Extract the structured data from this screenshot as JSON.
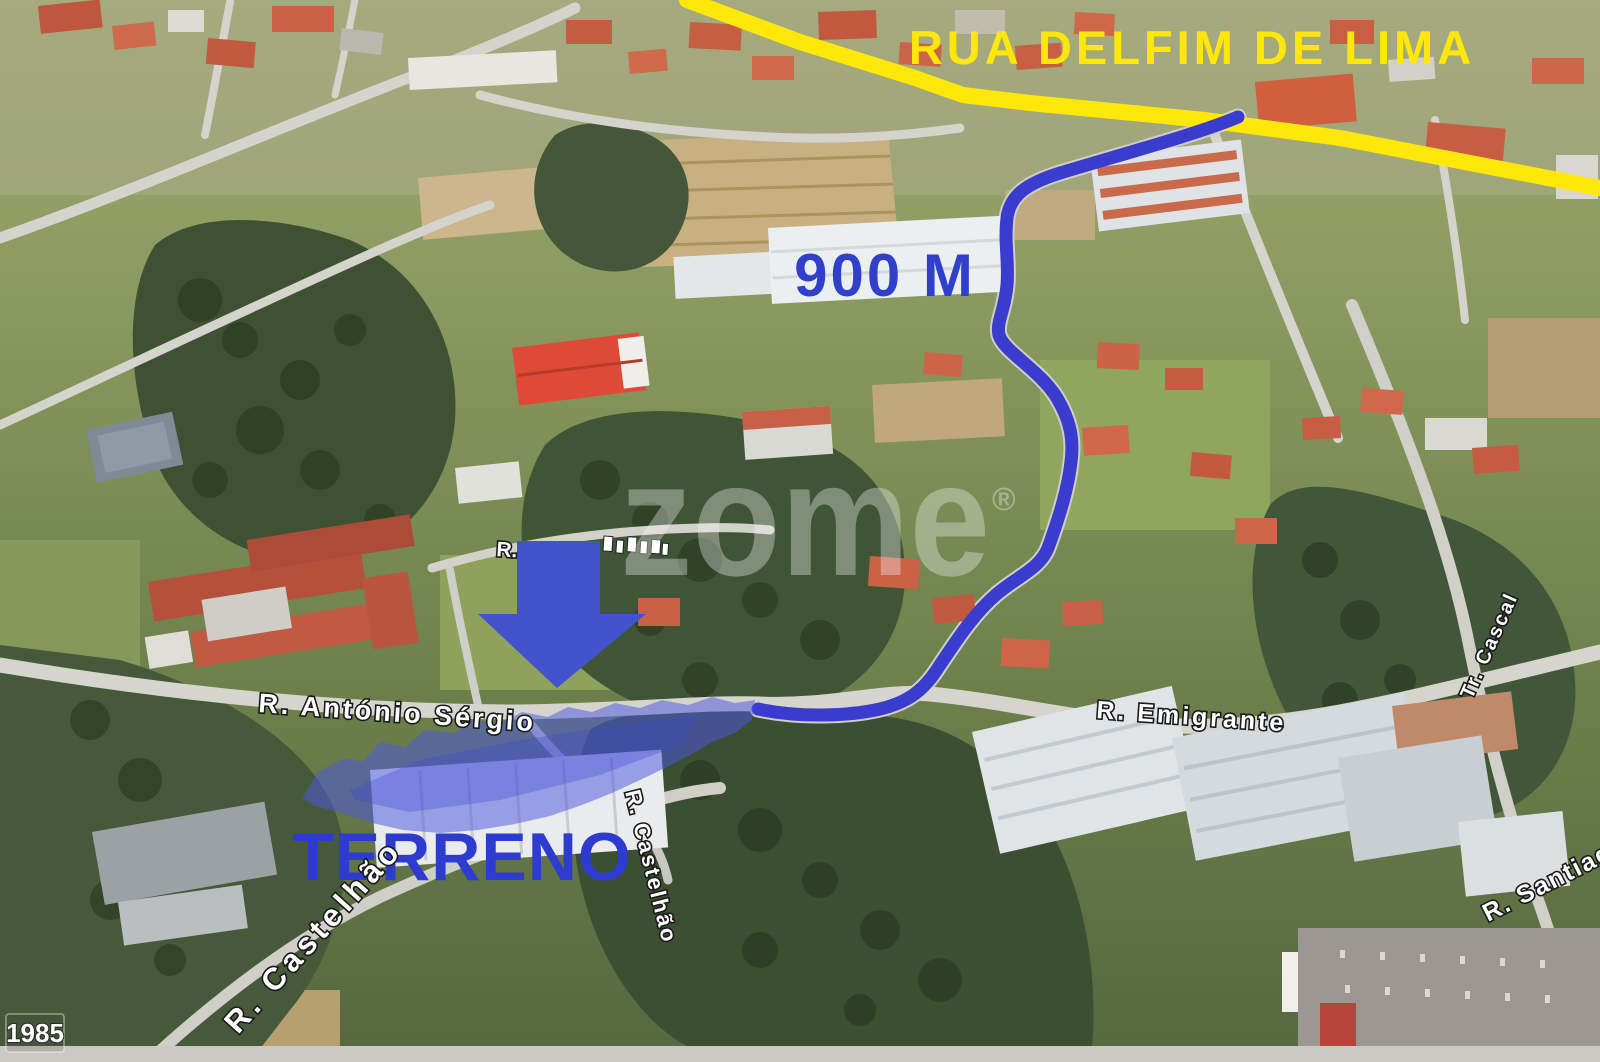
{
  "map": {
    "watermark": "zome",
    "watermark_symbol": "®",
    "imagery_year": "1985"
  },
  "annotations": {
    "main_road_label": "RUA DELFIM DE LIMA",
    "distance_label": "900 M",
    "plot_label": "TERRENO",
    "colors": {
      "road_highlight_yellow": "#FFE70A",
      "route_blue": "#3A3CCD",
      "plot_text_blue": "#2E3BCF"
    }
  },
  "streets": {
    "antonio_sergio": "R. António Sérgio",
    "emigrante": "R. Emigrante",
    "castelhao": "R. Castelhão",
    "castelhao_2": "R. Castelhão",
    "cascal": "Tr. Cascal",
    "santiago": "R. Santiago",
    "obscured": "R."
  }
}
